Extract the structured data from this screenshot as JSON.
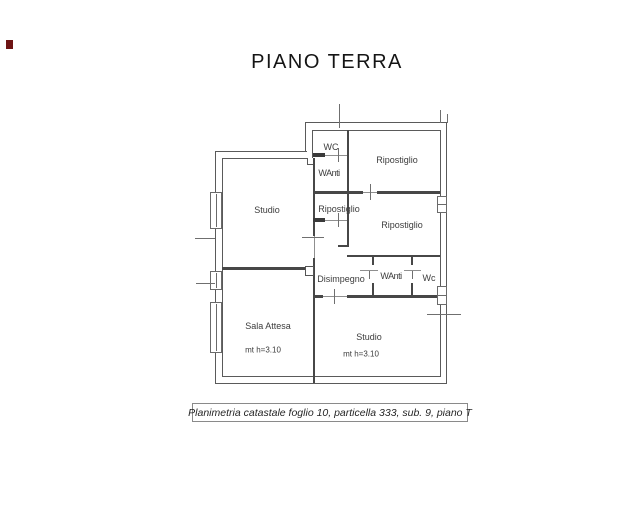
{
  "page": {
    "title": "PIANO TERRA"
  },
  "caption": {
    "text": "Planimetria catastale foglio 10, particella 333, sub. 9, piano T"
  },
  "rooms": {
    "wc_top": {
      "label": "WC"
    },
    "anti_top": {
      "label": "WAnti"
    },
    "ripostiglio_top_right": {
      "label": "Ripostiglio"
    },
    "studio_upper": {
      "label": "Studio"
    },
    "ripostiglio_mid": {
      "label": "Ripostiglio"
    },
    "ripostiglio_right": {
      "label": "Ripostiglio"
    },
    "disimpegno": {
      "label": "Disimpegno"
    },
    "anti_mid": {
      "label": "WAnti"
    },
    "wc_mid": {
      "label": "Wc"
    },
    "sala_attesa": {
      "label": "Sala Attesa",
      "height_note": "mt h=3.10"
    },
    "studio_lower": {
      "label": "Studio",
      "height_note": "mt h=3.10"
    }
  },
  "colors": {
    "wall": "#474747",
    "outer_line": "#5a5a5a",
    "text": "#3c3c3c",
    "artifact_mark": "#6e1414"
  }
}
